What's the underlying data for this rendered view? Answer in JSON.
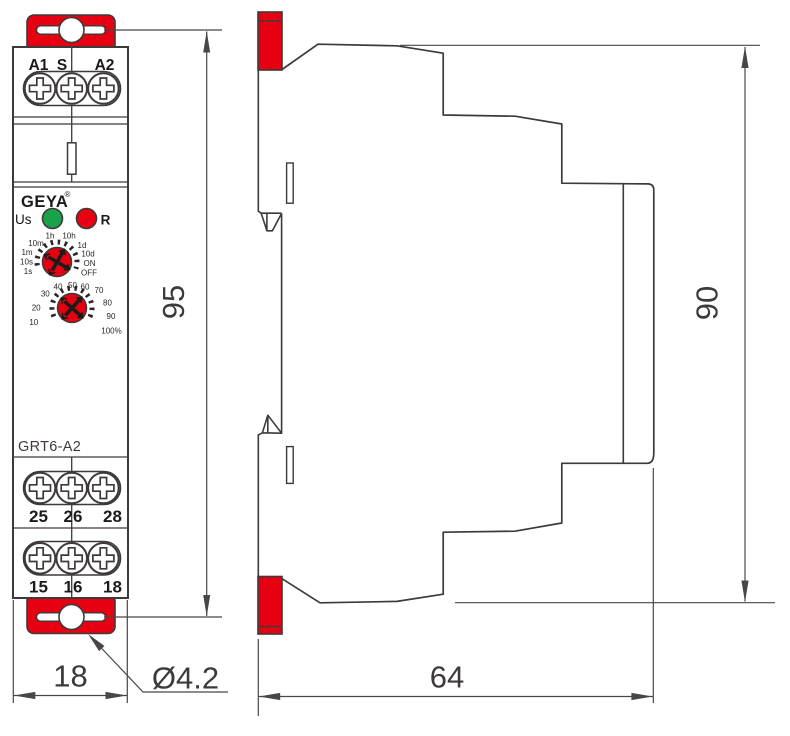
{
  "front": {
    "terminals_top": [
      "A1",
      "S",
      "A2"
    ],
    "brand": "GEYA",
    "reg_mark": "®",
    "power_led_label": "Us",
    "relay_led_label": "R",
    "model": "GRT6-A2",
    "time_dial_labels": [
      "1s",
      "10s",
      "1m",
      "10m",
      "1h",
      "10h",
      "1d",
      "10d",
      "ON",
      "OFF"
    ],
    "percent_dial_labels": [
      "10",
      "20",
      "30",
      "40",
      "50",
      "60",
      "70",
      "80",
      "90",
      "100%"
    ],
    "terminals_mid": [
      "25",
      "26",
      "28"
    ],
    "terminals_bottom": [
      "15",
      "16",
      "18"
    ]
  },
  "dimensions": {
    "front_height_mm": "95",
    "side_height_mm": "90",
    "front_width_mm": "18",
    "side_depth_mm": "64",
    "hole_diameter": "Ø4.2"
  },
  "colors": {
    "red": "#e60012",
    "green": "#1aa24b",
    "line_dark": "#3e3a39"
  }
}
